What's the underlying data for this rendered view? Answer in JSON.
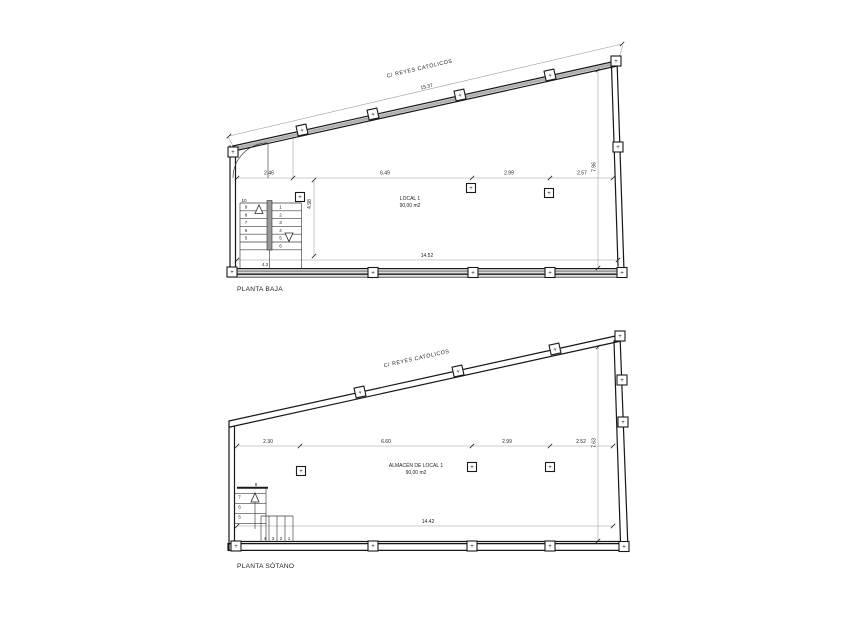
{
  "plans": {
    "baja": {
      "title": "PLANTA BAJA",
      "street": "C/ REYES CATÓLICOS",
      "overall": "15.37",
      "d1": "2.46",
      "d2": "6.49",
      "d3": "2.99",
      "d4": "2.57",
      "v_right": "7.96",
      "v_stair": "4.98",
      "bottom": "14.52",
      "stair_dim": "4.3",
      "room_name": "LOCAL 1",
      "room_area": "90,00 m2",
      "stair_left": [
        "10",
        "9",
        "8",
        "7",
        "6",
        "5"
      ],
      "stair_right": [
        "1",
        "2",
        "3",
        "4",
        "5",
        "6"
      ]
    },
    "sotano": {
      "title": "PLANTA SÓTANO",
      "street": "C/ REYES CATÓLICOS",
      "d1": "2.30",
      "d2": "6.60",
      "d3": "2.99",
      "d4": "2.52",
      "v_right": "7.63",
      "bottom": "14.42",
      "room_name": "ALMACÉN DE LOCAL 1",
      "room_area": "90,00 m2",
      "stair_vert": [
        "8",
        "7",
        "6",
        "5"
      ],
      "stair_run": [
        "4",
        "3",
        "2",
        "1"
      ]
    }
  },
  "symbols": {
    "column_marker": "+"
  },
  "colors": {
    "line": "#161616",
    "dimension": "#9a9a9a",
    "background": "#ffffff"
  }
}
